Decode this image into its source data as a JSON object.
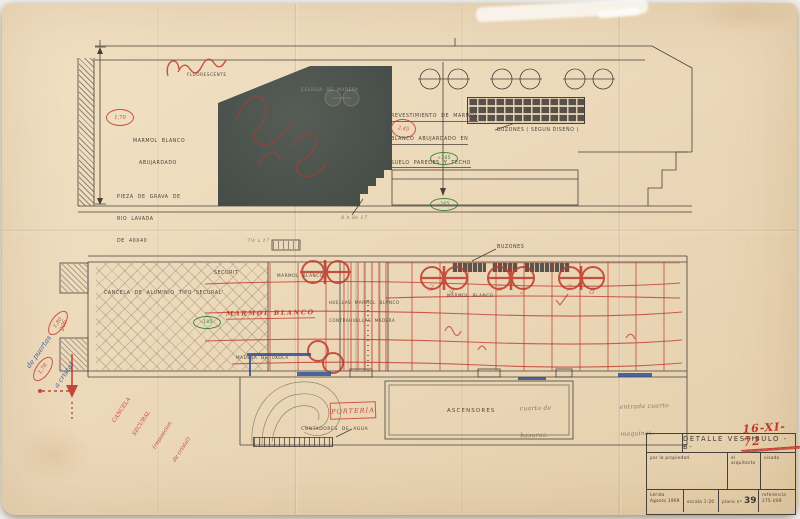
{
  "sheet": {
    "colors": {
      "paper": "#ecd9ba",
      "ink": "#46403a",
      "red_pencil": "#c0392b",
      "blue_pencil": "#2f55a4",
      "green_ink": "#2e7d32",
      "pencil": "#8b7f6a",
      "dark_panel": "#4d544e"
    },
    "handstamp_date": "16-XI-72",
    "title_block": {
      "title": "DETALLE  VESTIBULO  -B-",
      "col_propiedad": "por la propiedad",
      "col_arquitecto": "el arquitecto",
      "col_visado": "visado",
      "city": "Lérida",
      "month_year": "Agosto 1969",
      "escala": "escala  1:20",
      "plano_prefix": "plano nº",
      "plano_num": "39",
      "referencia_label": "referencia",
      "referencia_num": "275-I/69"
    },
    "elevation": {
      "fluorescente": "FLUORESCENTE",
      "marmol": [
        "MARMOL  BLANCO",
        "ABUJARDADO"
      ],
      "pieza": [
        "PIEZA  DE  GRAVA  DE",
        "RIO  LAVADA",
        "DE  40X40"
      ],
      "revestimiento": [
        "REVESTIMIENTO  DE  MARMOL",
        "BLANCO  ABUJARDADO  EN",
        "SUELO  PAREDES  Y  TECHO"
      ],
      "buzones": "BUZONES ( SEGUN DISEÑO )",
      "celosia": "CELOSIA  DE  MADERA",
      "steps_note": "8 h de 17",
      "dim_alto": "1,70",
      "dim_circle": "2,45",
      "nivel_sup": "+265",
      "nivel_inf": "-265"
    },
    "plan": {
      "securit": "SECURIT",
      "marmol_top": "MARMOL  BLANCO",
      "cancela": "CANCELA  DE  ALUMINIO  TIPO 'SECURAL'",
      "huellas": [
        "HUELLAS  MARMOL  BLANCO",
        "CONTRAHUELLAS  MADERA"
      ],
      "marmol_mid": "MARMOL  BLANCO",
      "buzones": "BUZONES",
      "madera_ukola": "MADERA  DE  UKOLA",
      "ascensores": "ASCENSORES",
      "contadores": "CONTADORES  DE  AGUA",
      "nivel": "-185",
      "pencil_dim": "7½ x 17",
      "red_marmol": "MARMOL BLANCO",
      "red_porteria": "PORTERIA",
      "red_digits": [
        "3",
        "4",
        "5",
        "2",
        "7",
        "8"
      ],
      "pencil_basuras": [
        "cuarto de",
        "basuras."
      ],
      "pencil_maquinas": [
        "entrada cuarto",
        "maquinas."
      ]
    },
    "margin": {
      "blue_note": [
        "de puertas",
        "a cristal"
      ],
      "red_dim_a": "1,80",
      "red_dim_b": "1,78",
      "red_scribble": "206",
      "red_note": [
        "CANCELA",
        "SECURAL",
        "(reposicion",
        "de cristal)"
      ]
    }
  }
}
